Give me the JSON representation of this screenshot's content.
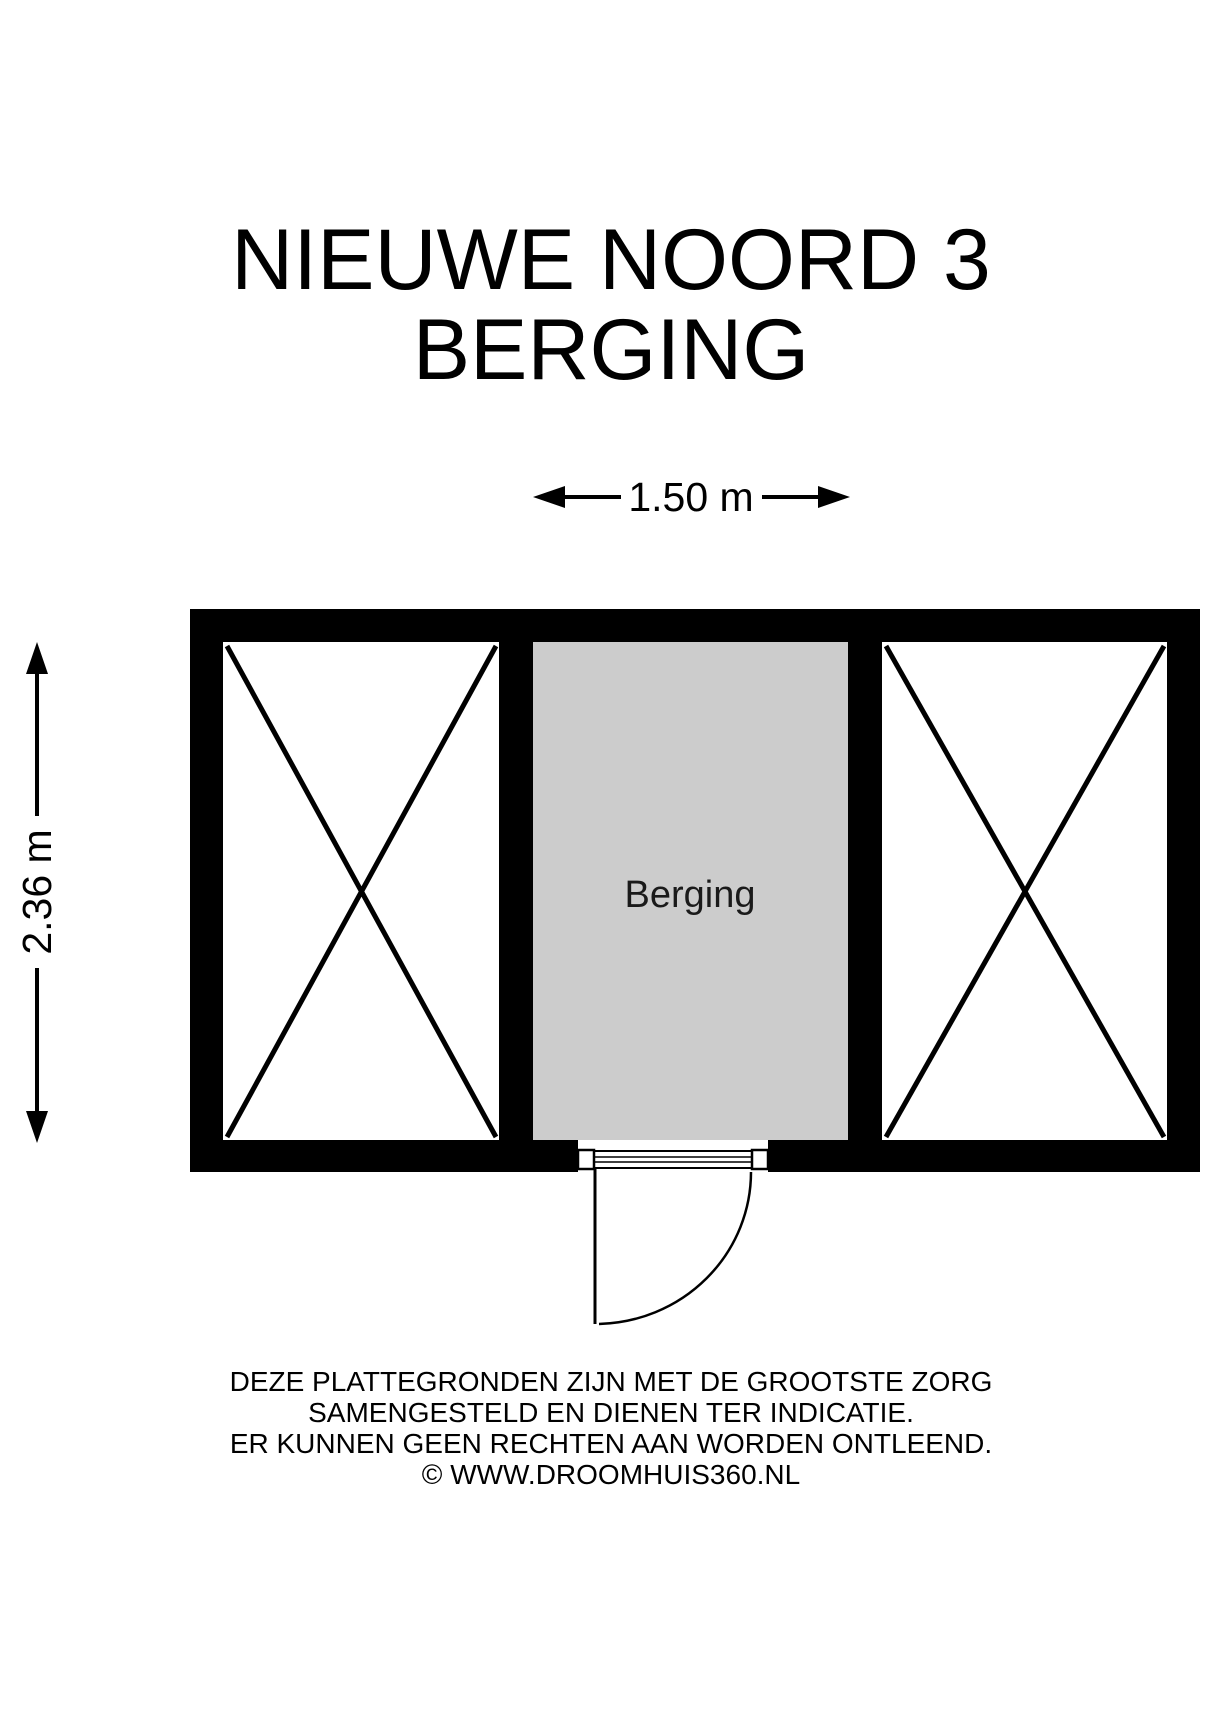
{
  "page": {
    "background": "#ffffff"
  },
  "title": {
    "line1": "NIEUWE NOORD 3",
    "line2": "BERGING"
  },
  "dimensions": {
    "width": {
      "label": "1.50 m"
    },
    "height": {
      "label": "2.36 m"
    }
  },
  "floorplan": {
    "room_label": "Berging",
    "colors": {
      "wall": "#000000",
      "room_fill": "#cccccc",
      "adjacent_fill": "#ffffff",
      "line": "#000000"
    }
  },
  "footer": {
    "line1": "DEZE PLATTEGRONDEN ZIJN MET DE GROOTSTE ZORG",
    "line2": "SAMENGESTELD EN DIENEN TER INDICATIE.",
    "line3": "ER KUNNEN GEEN RECHTEN AAN WORDEN ONTLEEND.",
    "line4": "© WWW.DROOMHUIS360.NL"
  }
}
